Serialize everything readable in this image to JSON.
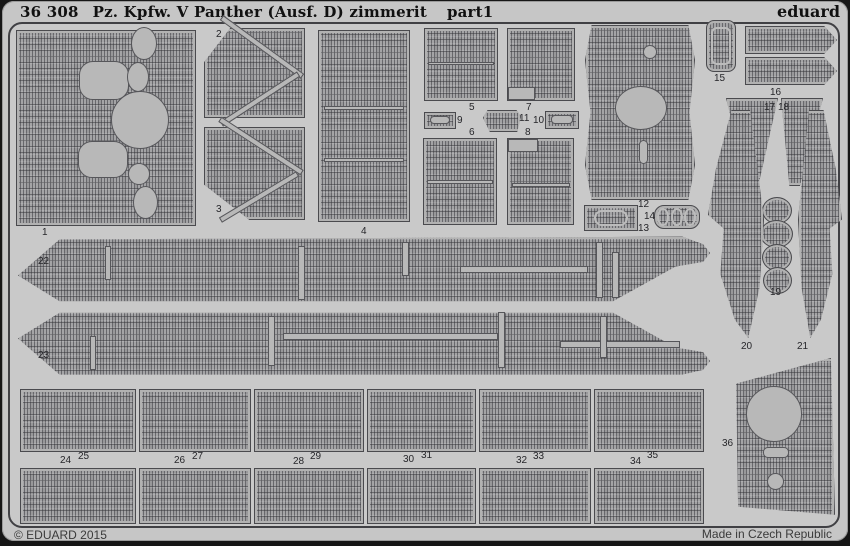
{
  "header": {
    "catalog": "36 308",
    "title": "Pz. Kpfw. V Panther (Ausf. D) zimmerit",
    "part_label": "part1",
    "brand": "eduard"
  },
  "footer": {
    "copyright": "© EDUARD 2015",
    "origin": "Made in Czech Republic"
  },
  "colors": {
    "background": "#161616",
    "sheet": "#c6c6c6",
    "part_base": "#a4a4a6",
    "cutout": "#b8b8b8",
    "border": "#404044",
    "text": "#1a1a1a"
  },
  "parts": [
    {
      "label": "1",
      "lx": 42,
      "ly": 228,
      "shapes": [
        {
          "x": 16,
          "y": 30,
          "w": 180,
          "h": 196
        }
      ],
      "cuts": [
        {
          "x": 79,
          "y": 61,
          "w": 50,
          "h": 39,
          "r": 14
        },
        {
          "x": 111,
          "y": 91,
          "w": 58,
          "h": 58,
          "r": "50%"
        },
        {
          "x": 78,
          "y": 141,
          "w": 50,
          "h": 37,
          "r": 14
        },
        {
          "x": 131,
          "y": 27,
          "w": 26,
          "h": 33,
          "r": "50%"
        },
        {
          "x": 127,
          "y": 62,
          "w": 22,
          "h": 30,
          "r": "50%"
        },
        {
          "x": 128,
          "y": 163,
          "w": 22,
          "h": 22,
          "r": "50%"
        },
        {
          "x": 133,
          "y": 186,
          "w": 25,
          "h": 33,
          "r": "50%"
        }
      ]
    },
    {
      "label": "2",
      "lx": 216,
      "ly": 30,
      "shapes": [
        {
          "x": 204,
          "y": 28,
          "w": 101,
          "h": 90,
          "clip": "polygon(26% 0%, 100% 0%, 100% 100%, 0% 100%, 0% 38%)"
        }
      ],
      "cuts": [
        {
          "x": 212,
          "y": 44,
          "w": 100,
          "h": 6,
          "rot": 36
        },
        {
          "x": 214,
          "y": 96,
          "w": 92,
          "h": 6,
          "rot": -33
        }
      ]
    },
    {
      "label": "3",
      "lx": 216,
      "ly": 205,
      "shapes": [
        {
          "x": 204,
          "y": 127,
          "w": 101,
          "h": 93,
          "clip": "polygon(0% 0%, 100% 0%, 100% 100%, 45% 100%, 0% 62%)"
        }
      ],
      "cuts": [
        {
          "x": 212,
          "y": 143,
          "w": 98,
          "h": 6,
          "rot": 33
        },
        {
          "x": 214,
          "y": 194,
          "w": 90,
          "h": 6,
          "rot": -31
        }
      ]
    },
    {
      "label": "4",
      "lx": 361,
      "ly": 227,
      "shapes": [
        {
          "x": 318,
          "y": 30,
          "w": 92,
          "h": 192
        }
      ],
      "cuts": [
        {
          "x": 324,
          "y": 106,
          "w": 80,
          "h": 4
        },
        {
          "x": 324,
          "y": 158,
          "w": 80,
          "h": 4
        }
      ]
    },
    {
      "label": "5",
      "lx": 469,
      "ly": 103,
      "shapes": [
        {
          "x": 424,
          "y": 28,
          "w": 74,
          "h": 73
        }
      ],
      "cuts": [
        {
          "x": 428,
          "y": 62,
          "w": 66,
          "h": 3
        }
      ]
    },
    {
      "label": "6",
      "lx": 469,
      "ly": 128,
      "shapes": [
        {
          "x": 423,
          "y": 138,
          "w": 74,
          "h": 87
        }
      ],
      "cuts": [
        {
          "x": 427,
          "y": 180,
          "w": 66,
          "h": 4
        }
      ]
    },
    {
      "label": "7",
      "lx": 526,
      "ly": 103,
      "shapes": [
        {
          "x": 507,
          "y": 28,
          "w": 68,
          "h": 73
        }
      ],
      "cuts": [
        {
          "x": 508,
          "y": 87,
          "w": 27,
          "h": 13
        }
      ]
    },
    {
      "label": "8",
      "lx": 525,
      "ly": 128,
      "shapes": [
        {
          "x": 507,
          "y": 138,
          "w": 67,
          "h": 87
        }
      ],
      "cuts": [
        {
          "x": 508,
          "y": 139,
          "w": 30,
          "h": 13
        },
        {
          "x": 512,
          "y": 183,
          "w": 58,
          "h": 4
        }
      ]
    },
    {
      "label": "9",
      "lx": 457,
      "ly": 116,
      "shapes": [
        {
          "x": 424,
          "y": 112,
          "w": 32,
          "h": 17
        }
      ],
      "cuts": [
        {
          "x": 430,
          "y": 116,
          "w": 20,
          "h": 8,
          "r": 4
        }
      ]
    },
    {
      "label": "10",
      "lx": 533,
      "ly": 116,
      "shapes": [
        {
          "x": 545,
          "y": 111,
          "w": 34,
          "h": 18
        }
      ],
      "cuts": [
        {
          "x": 551,
          "y": 115,
          "w": 22,
          "h": 9,
          "r": 4
        }
      ]
    },
    {
      "label": "11",
      "lx": 519,
      "ly": 114,
      "shapes": [
        {
          "x": 483,
          "y": 110,
          "w": 38,
          "h": 22,
          "clip": "polygon(0% 35%, 12% 0%, 88% 0%, 100% 30%, 90% 100%, 18% 100%)"
        }
      ],
      "cuts": []
    },
    {
      "label": "12",
      "lx": 638,
      "ly": 200,
      "shapes": [
        {
          "x": 585,
          "y": 25,
          "w": 110,
          "h": 175,
          "clip": "polygon(6% 0%, 94% 0%, 100% 20%, 95% 50%, 100% 80%, 94% 100%, 6% 100%, 0% 80%, 5% 50%, 0% 20%)"
        }
      ],
      "cuts": [
        {
          "x": 615,
          "y": 86,
          "w": 52,
          "h": 44,
          "r": "50%"
        },
        {
          "x": 643,
          "y": 45,
          "w": 14,
          "h": 14,
          "r": "50%"
        },
        {
          "x": 639,
          "y": 140,
          "w": 9,
          "h": 24,
          "r": 5
        }
      ]
    },
    {
      "label": "13",
      "lx": 638,
      "ly": 224,
      "shapes": [
        {
          "x": 584,
          "y": 205,
          "w": 54,
          "h": 26
        }
      ],
      "cuts": [
        {
          "x": 594,
          "y": 210,
          "w": 34,
          "h": 16,
          "r": 8,
          "kind": "ring"
        }
      ]
    },
    {
      "label": "14",
      "lx": 644,
      "ly": 212,
      "shapes": [
        {
          "x": 654,
          "y": 205,
          "w": 46,
          "h": 24,
          "r": 10
        }
      ],
      "cuts": [
        {
          "x": 657,
          "y": 208,
          "w": 12,
          "h": 18,
          "r": "50%",
          "kind": "ring"
        },
        {
          "x": 671,
          "y": 208,
          "w": 12,
          "h": 18,
          "r": "50%",
          "kind": "ring"
        },
        {
          "x": 684,
          "y": 208,
          "w": 12,
          "h": 18,
          "r": "50%",
          "kind": "ring"
        }
      ]
    },
    {
      "label": "15",
      "lx": 714,
      "ly": 74,
      "shapes": [
        {
          "x": 706,
          "y": 20,
          "w": 30,
          "h": 52,
          "r": 8
        }
      ],
      "cuts": [
        {
          "x": 711,
          "y": 27,
          "w": 20,
          "h": 38,
          "r": 6,
          "kind": "ring"
        }
      ]
    },
    {
      "label": "16",
      "lx": 770,
      "ly": 88,
      "shapes": [
        {
          "x": 745,
          "y": 26,
          "w": 92,
          "h": 28,
          "clip": "polygon(0% 0%, 86% 0%, 100% 50%, 86% 100%, 0% 100%)"
        },
        {
          "x": 745,
          "y": 57,
          "w": 92,
          "h": 28,
          "clip": "polygon(0% 0%, 86% 0%, 100% 50%, 86% 100%, 0% 100%)"
        }
      ],
      "cuts": []
    },
    {
      "label": "17",
      "lx": 764,
      "ly": 103,
      "shapes": [
        {
          "x": 726,
          "y": 98,
          "w": 52,
          "h": 88,
          "clip": "polygon(0% 0%, 100% 0%, 62% 100%, 42% 100%)"
        }
      ],
      "cuts": []
    },
    {
      "label": "18",
      "lx": 778,
      "ly": 103,
      "shapes": [
        {
          "x": 781,
          "y": 98,
          "w": 42,
          "h": 88,
          "clip": "polygon(0% 0%, 100% 0%, 45% 100%, 20% 100%)"
        }
      ],
      "cuts": []
    },
    {
      "label": "19",
      "lx": 770,
      "ly": 288,
      "shapes": [
        {
          "x": 762,
          "y": 197,
          "w": 30,
          "h": 27,
          "r": "50%"
        },
        {
          "x": 760,
          "y": 220,
          "w": 33,
          "h": 28,
          "r": "50%"
        },
        {
          "x": 762,
          "y": 244,
          "w": 30,
          "h": 27,
          "r": "50%"
        },
        {
          "x": 763,
          "y": 267,
          "w": 29,
          "h": 27,
          "r": "50%"
        }
      ],
      "cuts": []
    },
    {
      "label": "20",
      "lx": 741,
      "ly": 342,
      "shapes": [
        {
          "x": 708,
          "y": 110,
          "w": 56,
          "h": 228,
          "clip": "polygon(42% 0%, 75% 0%, 100% 48%, 92% 78%, 72% 100%, 48% 92%, 22% 72%, 28% 52%, 0% 46%, 14% 26%)"
        }
      ],
      "cuts": []
    },
    {
      "label": "21",
      "lx": 797,
      "ly": 342,
      "shapes": [
        {
          "x": 798,
          "y": 110,
          "w": 44,
          "h": 228,
          "clip": "polygon(25% 0%, 58% 0%, 86% 26%, 100% 48%, 72% 52%, 78% 72%, 52% 92%, 28% 100%, 8% 78%, 0% 48%)"
        }
      ],
      "cuts": []
    },
    {
      "label": "22",
      "lx": 38,
      "ly": 257,
      "shapes": [
        {
          "x": 18,
          "y": 236,
          "w": 692,
          "h": 68,
          "clip": "polygon(0% 58%, 6% 5%, 96% 1%, 99% 12%, 100% 25%, 99% 38%, 95% 45%, 86% 96%, 6% 96%)"
        }
      ],
      "cuts": [
        {
          "x": 105,
          "y": 246,
          "w": 6,
          "h": 34
        },
        {
          "x": 298,
          "y": 246,
          "w": 7,
          "h": 54
        },
        {
          "x": 402,
          "y": 242,
          "w": 7,
          "h": 34
        },
        {
          "x": 460,
          "y": 266,
          "w": 128,
          "h": 7
        },
        {
          "x": 596,
          "y": 242,
          "w": 7,
          "h": 56
        },
        {
          "x": 612,
          "y": 252,
          "w": 7,
          "h": 46
        }
      ]
    },
    {
      "label": "23",
      "lx": 38,
      "ly": 351,
      "shapes": [
        {
          "x": 18,
          "y": 310,
          "w": 692,
          "h": 68,
          "clip": "polygon(6% 4%, 86% 4%, 95% 55%, 99% 62%, 100% 75%, 99% 88%, 96% 95%, 6% 95%, 0% 42%)"
        }
      ],
      "cuts": [
        {
          "x": 90,
          "y": 336,
          "w": 6,
          "h": 34
        },
        {
          "x": 268,
          "y": 316,
          "w": 7,
          "h": 50
        },
        {
          "x": 283,
          "y": 333,
          "w": 215,
          "h": 7
        },
        {
          "x": 498,
          "y": 312,
          "w": 7,
          "h": 56
        },
        {
          "x": 560,
          "y": 341,
          "w": 120,
          "h": 7
        },
        {
          "x": 600,
          "y": 316,
          "w": 7,
          "h": 42
        }
      ]
    },
    {
      "label": "25",
      "lx": 78,
      "ly": 452,
      "shapes": [
        {
          "x": 20,
          "y": 389,
          "w": 116,
          "h": 63
        }
      ],
      "cuts": []
    },
    {
      "label": "27",
      "lx": 192,
      "ly": 452,
      "shapes": [
        {
          "x": 139,
          "y": 389,
          "w": 112,
          "h": 63
        }
      ],
      "cuts": []
    },
    {
      "label": "29",
      "lx": 310,
      "ly": 452,
      "shapes": [
        {
          "x": 254,
          "y": 389,
          "w": 110,
          "h": 63
        }
      ],
      "cuts": []
    },
    {
      "label": "31",
      "lx": 421,
      "ly": 451,
      "shapes": [
        {
          "x": 367,
          "y": 389,
          "w": 109,
          "h": 63
        }
      ],
      "cuts": []
    },
    {
      "label": "33",
      "lx": 533,
      "ly": 452,
      "shapes": [
        {
          "x": 479,
          "y": 389,
          "w": 112,
          "h": 63
        }
      ],
      "cuts": []
    },
    {
      "label": "35",
      "lx": 647,
      "ly": 451,
      "shapes": [
        {
          "x": 594,
          "y": 389,
          "w": 110,
          "h": 63
        }
      ],
      "cuts": []
    },
    {
      "label": "24",
      "lx": 60,
      "ly": 456,
      "shapes": [
        {
          "x": 20,
          "y": 468,
          "w": 116,
          "h": 56
        }
      ],
      "cuts": []
    },
    {
      "label": "26",
      "lx": 174,
      "ly": 456,
      "shapes": [
        {
          "x": 139,
          "y": 468,
          "w": 112,
          "h": 56
        }
      ],
      "cuts": []
    },
    {
      "label": "28",
      "lx": 293,
      "ly": 457,
      "shapes": [
        {
          "x": 254,
          "y": 468,
          "w": 110,
          "h": 56
        }
      ],
      "cuts": []
    },
    {
      "label": "30",
      "lx": 403,
      "ly": 455,
      "shapes": [
        {
          "x": 367,
          "y": 468,
          "w": 109,
          "h": 56
        }
      ],
      "cuts": []
    },
    {
      "label": "32",
      "lx": 516,
      "ly": 456,
      "shapes": [
        {
          "x": 479,
          "y": 468,
          "w": 112,
          "h": 56
        }
      ],
      "cuts": []
    },
    {
      "label": "34",
      "lx": 630,
      "ly": 457,
      "shapes": [
        {
          "x": 594,
          "y": 468,
          "w": 110,
          "h": 56
        }
      ],
      "cuts": []
    },
    {
      "label": "36",
      "lx": 722,
      "ly": 439,
      "shapes": [
        {
          "x": 733,
          "y": 358,
          "w": 102,
          "h": 160,
          "clip": "polygon(3% 16%, 96% 0%, 100% 98%, 5% 93%)"
        }
      ],
      "cuts": [
        {
          "x": 746,
          "y": 386,
          "w": 56,
          "h": 56,
          "r": "50%"
        },
        {
          "x": 763,
          "y": 447,
          "w": 26,
          "h": 11,
          "r": 5
        },
        {
          "x": 767,
          "y": 473,
          "w": 17,
          "h": 17,
          "r": "50%"
        }
      ]
    }
  ]
}
